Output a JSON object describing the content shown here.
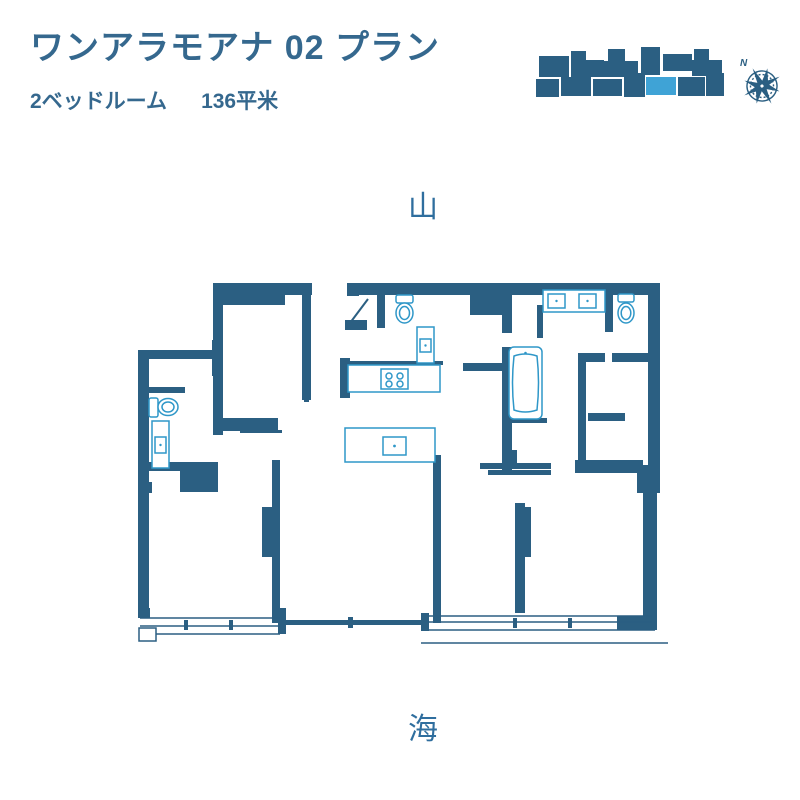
{
  "header": {
    "title": "ワンアラモアナ 02 プラン",
    "bedrooms": "2ベッドルーム",
    "area": "136平米"
  },
  "orientation": {
    "top": "山",
    "bottom": "海",
    "compass": "N"
  },
  "colors": {
    "wall": "#2B5F82",
    "fixture": "#2F97C8",
    "highlight": "#3FA3D6",
    "title_text": "#35688E",
    "label_text": "#2F6E9E"
  },
  "keyplan": {
    "name": "building-footprint-keyplan",
    "highlighted_unit": "02"
  },
  "floorplan": {
    "fixtures": [
      "toilet",
      "vanity-sink",
      "powder-toilet",
      "powder-sink",
      "kitchen-counter",
      "cooktop",
      "kitchen-island",
      "island-sink",
      "double-vanity",
      "master-toilet",
      "bathtub"
    ],
    "windows": [
      "left-window-band",
      "center-sliding-door",
      "right-window-band"
    ]
  }
}
